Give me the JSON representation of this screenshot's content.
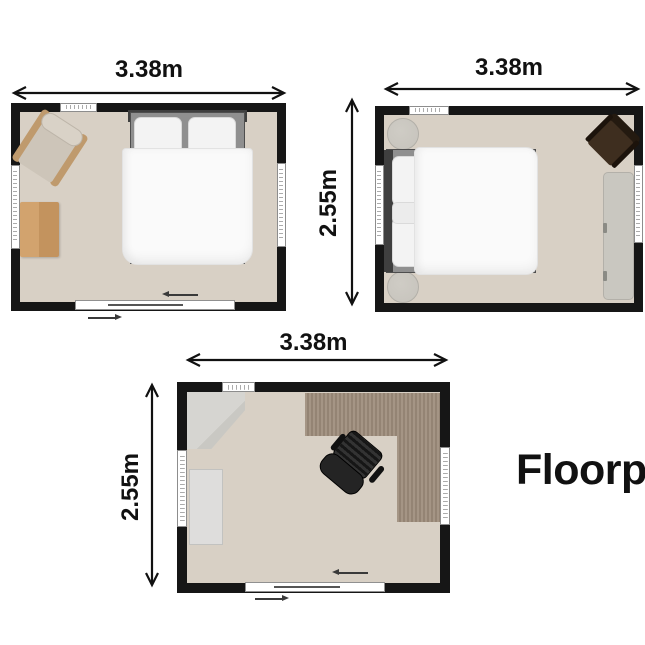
{
  "title": {
    "label": "Floorp"
  },
  "rooms": {
    "bedroom1": {
      "width_label": "3.38m"
    },
    "bedroom2": {
      "width_label": "3.38m",
      "height_label": "2.55m"
    },
    "office": {
      "width_label": "3.38m",
      "height_label": "2.55m"
    }
  },
  "colors": {
    "wall": "#161616",
    "floor": "#d8d0c5",
    "window_frame": "#8d8d8d",
    "text": "#111111",
    "bed_linen": "#fafafa",
    "headboard": "#3f3f3f",
    "armchair": "#cdc5b9",
    "armchair_wood": "#bf9a6d",
    "wood_table": "#d2a36e",
    "wood_desk": "#9d8c7b",
    "pouf": "#c6c3bc",
    "bench": "#c9c7c0",
    "chair_brown": "#3e2e1f",
    "cabinet": "#d6d5d1",
    "wardrobe": "#dedddc"
  }
}
